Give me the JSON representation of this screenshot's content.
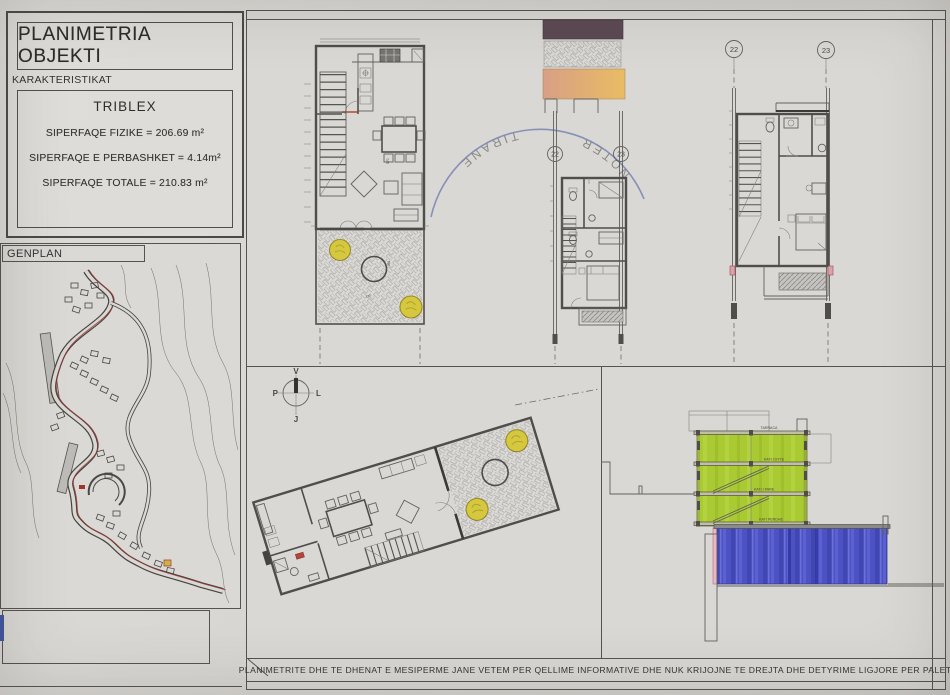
{
  "colors": {
    "paper": "#d8d6d2",
    "ink": "#504e4a",
    "section_green": "#aaca34",
    "section_blue": "#4d52c2",
    "tree_yellow": "#d5c83f",
    "band_dark": "#5c4953",
    "band_orange": "#e9bc64",
    "stamp_blue": "#4456a2"
  },
  "title_block": {
    "title": "PLANIMETRIA OBJEKTI",
    "section_label": "KARAKTERISTIKAT",
    "unit": "TRIBLEX",
    "areas": [
      "SIPERFAQE  FIZIKE  =  206.69  m²",
      "SIPERFAQE E PERBASHKET  =  4.14m²",
      "SIPERFAQE TOTALE  =  210.83 m²"
    ]
  },
  "genplan": {
    "label": "GENPLAN"
  },
  "axes": {
    "a": "22",
    "b": "23"
  },
  "compass": {
    "north": "V",
    "east": "L",
    "south": "J",
    "west": "P"
  },
  "dims": {
    "dining": "570",
    "terrace": "381",
    "step": "120"
  },
  "section": {
    "roof": "TARRACA",
    "floor2": "KATI I DYTE",
    "floor1": "KATI I PARE",
    "ground": "KATI PERDHE"
  },
  "stamp": {
    "word1": "NOTER",
    "word2": "TIRANE"
  },
  "footer": {
    "disclaimer": "PLANIMETRITE DHE TE DHENAT E MESIPERME JANE VETEM PER QELLIME INFORMATIVE DHE NUK KRIJOJNE TE DREJTA DHE DETYRIME LIGJORE PER PALET."
  }
}
